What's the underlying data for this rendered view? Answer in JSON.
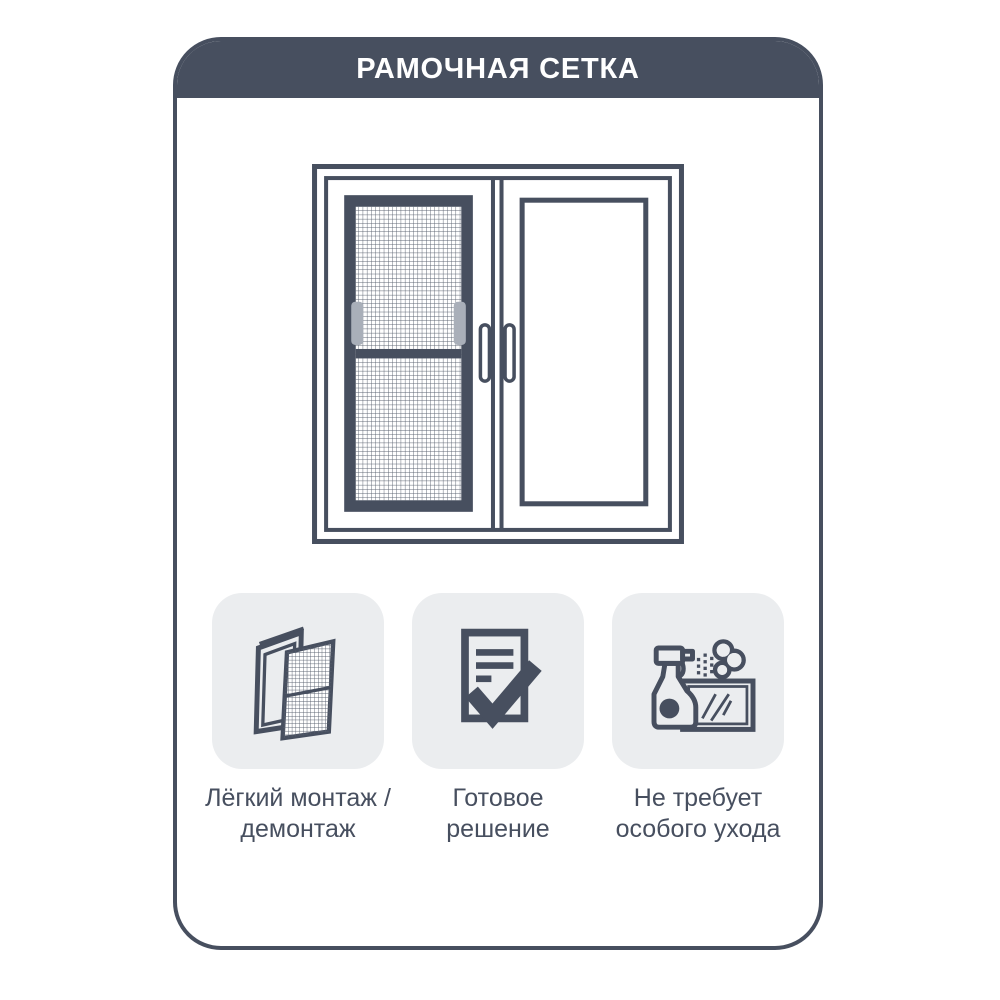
{
  "colors": {
    "accent": "#474F5F",
    "icon_background": "#EBEDEF",
    "mesh_handle_gray": "#A9AFB9",
    "background": "#FFFFFF",
    "title_text": "#FFFFFF"
  },
  "header": {
    "title": "РАМОЧНАЯ СЕТКА"
  },
  "illustration": {
    "name": "window-with-frame-mosquito-net"
  },
  "features": [
    {
      "icon": "easy-install-icon",
      "label": "Лёгкий монтаж /\nдемонтаж"
    },
    {
      "icon": "ready-solution-icon",
      "label": "Готовое\nрешение"
    },
    {
      "icon": "easy-care-icon",
      "label": "Не требует\nособого ухода"
    }
  ]
}
